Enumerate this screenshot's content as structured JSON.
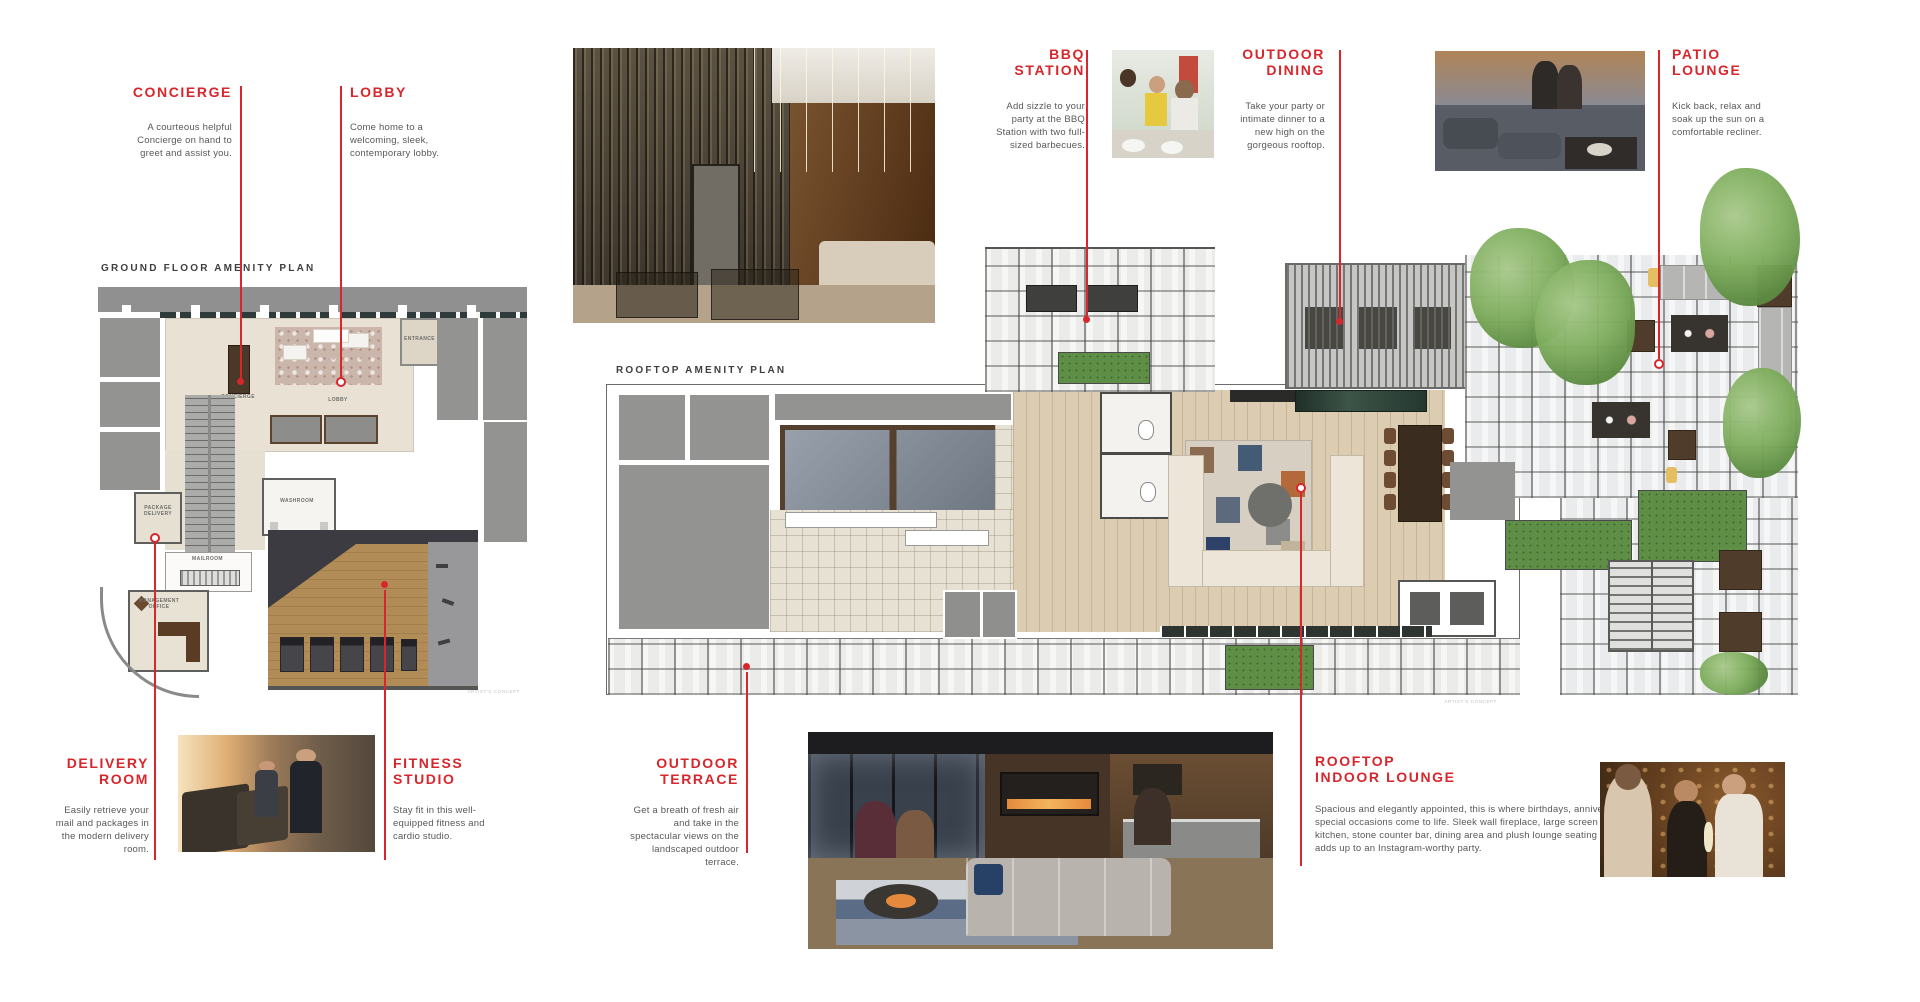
{
  "colors": {
    "accent": "#d7262c",
    "body_text": "#57585a",
    "plan_title_text": "#3f3f41"
  },
  "callouts": {
    "concierge": {
      "title": "CONCIERGE",
      "description": "A courteous helpful Concierge on hand to greet and assist you."
    },
    "lobby": {
      "title": "LOBBY",
      "description": "Come home to a welcoming, sleek, contemporary lobby."
    },
    "bbq_station": {
      "title": "BBQ\nSTATION",
      "description": "Add sizzle to your party at the BBQ Station with two full-sized barbecues."
    },
    "outdoor_dining": {
      "title": "OUTDOOR\nDINING",
      "description": "Take your party or intimate dinner to a new high on the gorgeous rooftop."
    },
    "patio_lounge": {
      "title": "PATIO\nLOUNGE",
      "description": "Kick back, relax and soak up the sun on a comfortable recliner."
    },
    "delivery_room": {
      "title": "DELIVERY\nROOM",
      "description": "Easily retrieve your mail and packages in the modern delivery room."
    },
    "fitness_studio": {
      "title": "FITNESS\nSTUDIO",
      "description": "Stay fit in this well-equipped fitness and cardio studio."
    },
    "outdoor_terrace": {
      "title": "OUTDOOR\nTERRACE",
      "description": "Get a breath of fresh air and take in the spectacular views on the landscaped outdoor terrace."
    },
    "rooftop_indoor_lounge": {
      "title": "ROOFTOP\nINDOOR LOUNGE",
      "description": "Spacious and elegantly appointed, this is where birthdays, anniversaries and special occasions come to life. Sleek wall fireplace, large screen TV, catering kitchen, stone counter bar, dining area and plush lounge seating – everything adds up to an Instagram-worthy party."
    }
  },
  "plans": {
    "ground": {
      "title": "GROUND FLOOR AMENITY PLAN",
      "caption": "ARTIST'S CONCEPT",
      "rooms": {
        "concierge": "CONCIERGE",
        "lobby": "LOBBY",
        "entrance": "ENTRANCE",
        "washroom": "WASHROOM",
        "mailroom": "MAILROOM",
        "package_delivery": "PACKAGE\nDELIVERY",
        "management_office": "MANAGEMENT\nOFFICE"
      }
    },
    "rooftop": {
      "title": "ROOFTOP AMENITY PLAN",
      "caption": "ARTIST'S CONCEPT"
    }
  }
}
